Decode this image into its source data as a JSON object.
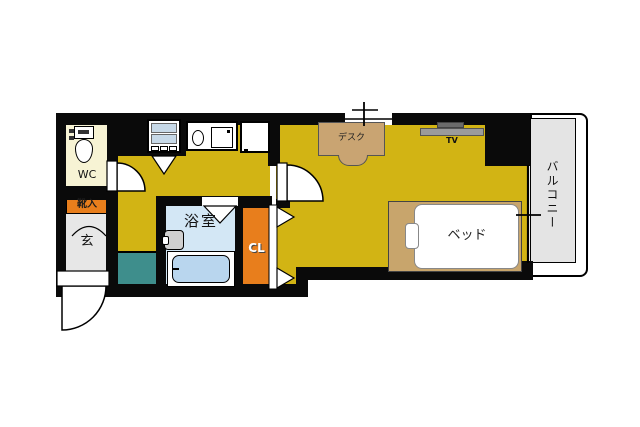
{
  "plan": {
    "title": "apartment-floorplan",
    "labels": {
      "wc": "WC",
      "shoe_storage": "靴入",
      "entrance": "玄",
      "bathroom": "浴室",
      "closet": "CL",
      "desk": "デスク",
      "tv": "TV",
      "bed": "ベッド",
      "balcony": "バルコニー"
    },
    "colors": {
      "wall": "#0a0a0a",
      "floor": "#d2b414",
      "closet": "#e87e1c",
      "shoe": "#e87e1c",
      "laundry": "#3e8e8c",
      "bathroom": "#d3e7f5",
      "bathtub": "#b9d6ee",
      "bed": "#c8a56c",
      "desk": "#c9a472",
      "wc": "#f7f3d4",
      "entrance": "#e7e7e7",
      "balcony": "#e4e4e4",
      "appliance": "#c7d9e8",
      "tvshelf": "#9b9b9b",
      "tvset": "#6b6b6b"
    }
  }
}
